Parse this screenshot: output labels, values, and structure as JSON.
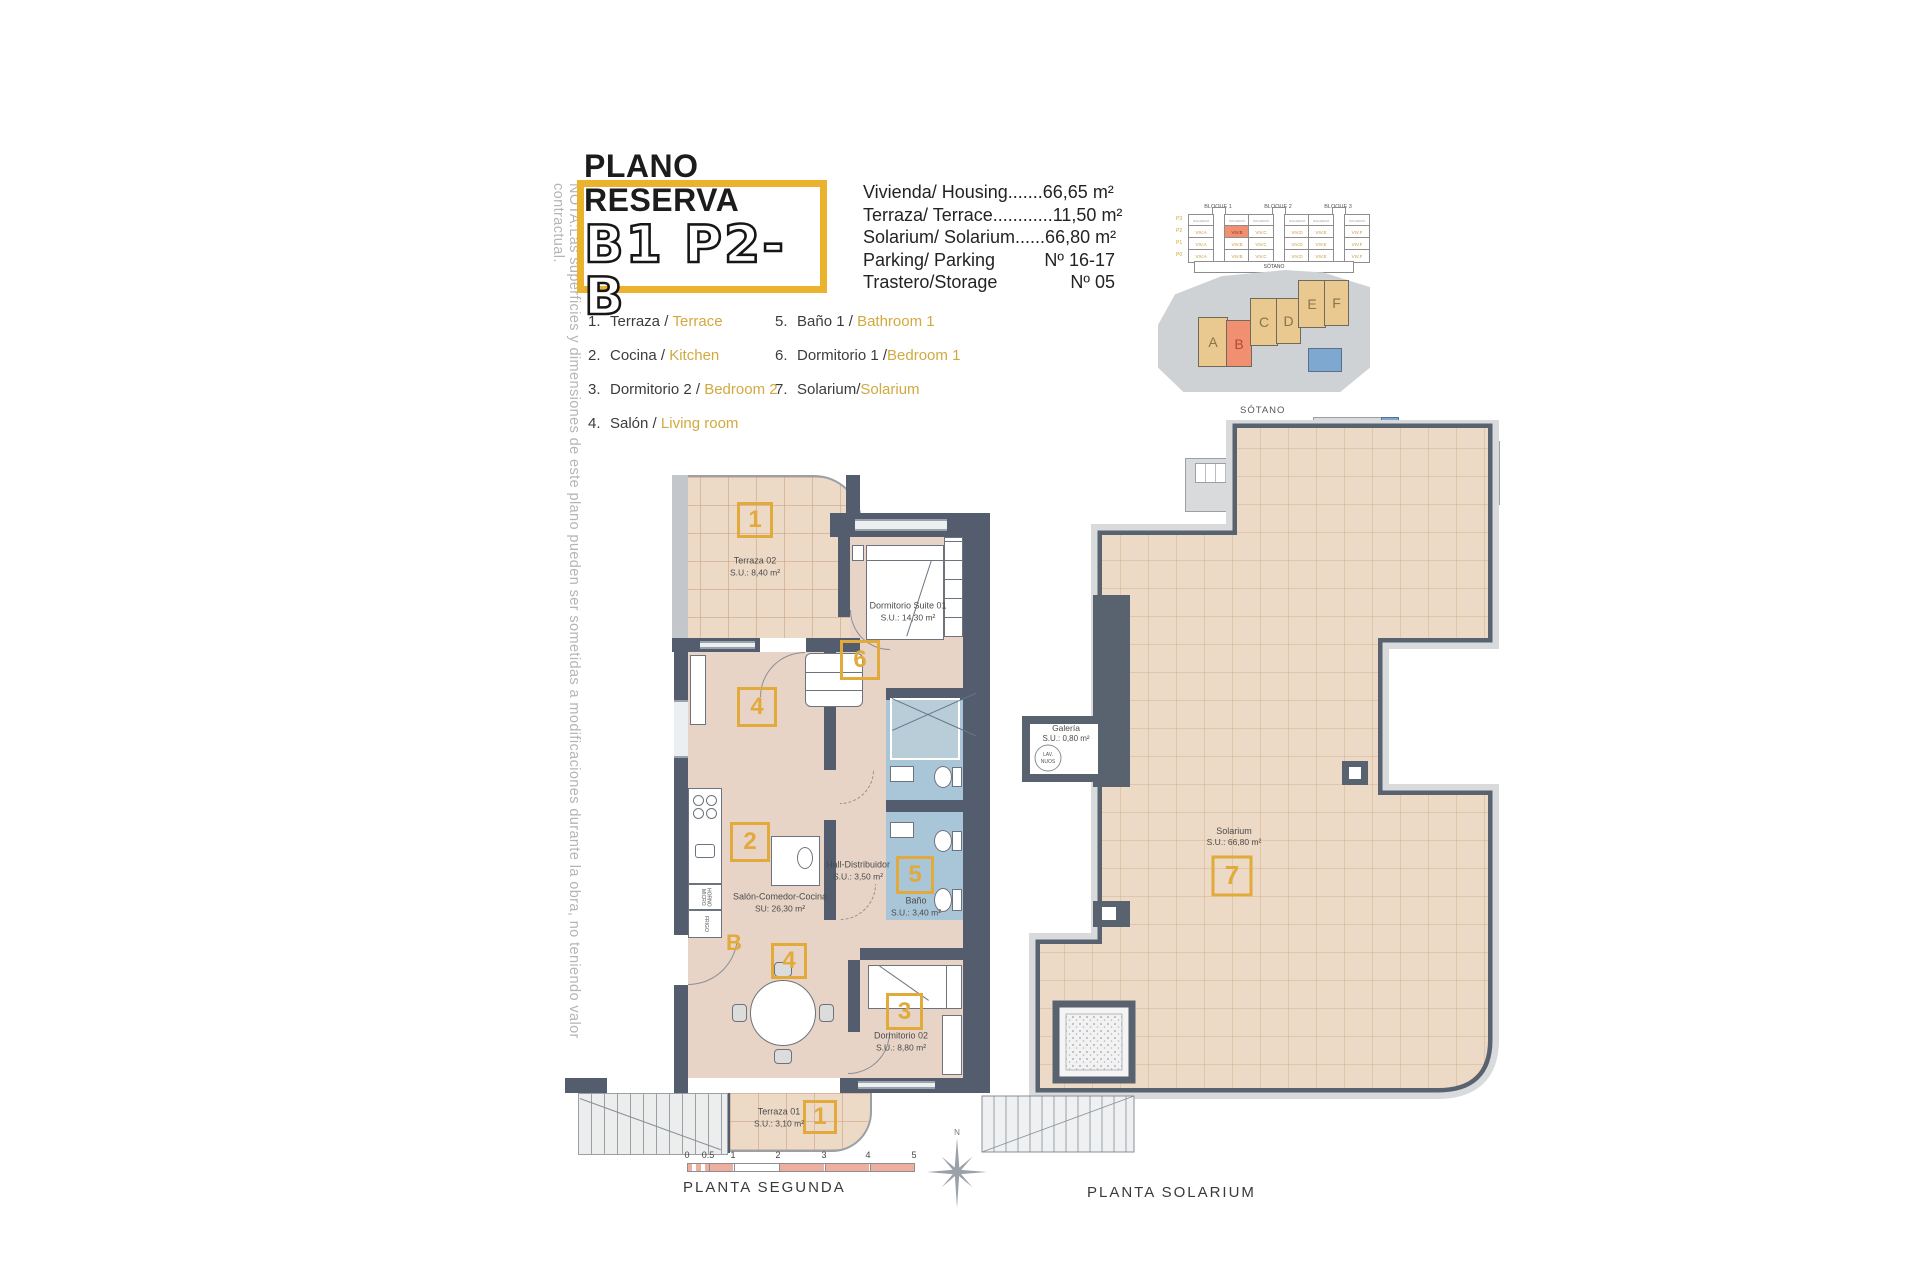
{
  "note": "NOTA:Las superficies y dimensiones de este plano pueden ser sometidas a modificaciones durante la obra, no teniendo valor contractual.",
  "title": {
    "line1": "PLANO RESERVA",
    "line2": "B1 P2-B"
  },
  "specs": {
    "rows": [
      {
        "text": "Vivienda/ Housing.......66,65 m²"
      },
      {
        "text": "Terraza/ Terrace............11,50 m²"
      },
      {
        "text": "Solarium/ Solarium......66,80 m²"
      }
    ],
    "parking_label": "Parking/ Parking",
    "parking_value": "Nº 16-17",
    "storage_label": "Trastero/Storage",
    "storage_value": "Nº 05"
  },
  "legend": {
    "col1": [
      {
        "num": "1.",
        "es": "Terraza",
        "sep": " / ",
        "en": "Terrace"
      },
      {
        "num": "2.",
        "es": "Cocina",
        "sep": " / ",
        "en": "Kitchen"
      },
      {
        "num": "3.",
        "es": "Dormitorio 2",
        "sep": " / ",
        "en": "Bedroom 2"
      },
      {
        "num": "4.",
        "es": "Salón",
        "sep": " / ",
        "en": "Living room"
      }
    ],
    "col2": [
      {
        "num": "5.",
        "es": "Baño 1",
        "sep": " / ",
        "en": "Bathroom 1"
      },
      {
        "num": "6.",
        "es": "Dormitorio 1",
        "sep": " /",
        "en": "Bedroom 1"
      },
      {
        "num": "7.",
        "es": "Solarium",
        "sep": "/",
        "en": "Solarium"
      }
    ]
  },
  "elevation": {
    "blocks": [
      "BLOQUE 1",
      "BLOQUE 2",
      "BLOQUE 3"
    ],
    "floors": [
      "P3",
      "P2",
      "P1",
      "P0"
    ],
    "units": [
      "VIV.A",
      "VIV.B",
      "VIV.C",
      "VIV.D",
      "VIV.E",
      "VIV.F"
    ],
    "top_label": "SOLARIUM",
    "basement": "SÓTANO",
    "highlighted_floor": "P2",
    "highlighted_unit": "VIV.B"
  },
  "site_plan": {
    "units": [
      "A",
      "B",
      "C",
      "D",
      "E",
      "F"
    ],
    "highlighted": "B"
  },
  "sotano_plan": {
    "label": "SÓTANO"
  },
  "plan_segunda": {
    "markers": {
      "terraza2": "1",
      "suite": "6",
      "salon_top": "4",
      "cocina": "2",
      "bano": "5",
      "salon_bottom": "4",
      "dorm2": "3",
      "terraza1": "1",
      "entrance_letter": "B"
    },
    "rooms": {
      "terraza2": {
        "name": "Terraza 02",
        "area": "S.U.: 8,40 m²"
      },
      "suite": {
        "name": "Dormitorio Suite 01",
        "area": "S.U.: 14,30 m²"
      },
      "hall": {
        "name": "Hall-Distribuidor",
        "area": "S.U.: 3,50 m²"
      },
      "salon": {
        "name": "Salón-Comedor-Cocina",
        "area": "SU: 26,30 m²"
      },
      "bano": {
        "name": "Baño",
        "area": "S.U.: 3,40 m²"
      },
      "dorm2": {
        "name": "Dormitorio 02",
        "area": "S.U.: 8,80 m²"
      },
      "terraza1": {
        "name": "Terraza 01",
        "area": "S.U.: 3,10 m²"
      }
    },
    "appliances": {
      "top": "HORNO MICRO",
      "bottom": "FRIGO"
    }
  },
  "plan_solarium": {
    "marker": "7",
    "rooms": {
      "solarium": {
        "name": "Solarium",
        "area": "S.U.: 66,80 m²"
      },
      "galeria": {
        "name": "Galería",
        "area": "S.U.: 0,80 m²"
      }
    },
    "laundry_line1": "LAV.",
    "laundry_line2": "NUOS"
  },
  "footer": {
    "planta_segunda": "PLANTA SEGUNDA",
    "planta_solarium": "PLANTA SOLARIUM",
    "scale_ticks": [
      "0",
      "0.5",
      "1",
      "2",
      "3",
      "4",
      "5"
    ],
    "north": "N"
  },
  "colors": {
    "accent_yellow": "#E2A93B",
    "title_border": "#EBB32D",
    "legend_yellow": "#D2A93F",
    "highlight_salmon": "#F09070",
    "wall_dark": "#535D6D",
    "floor_tan": "#E9D7C8",
    "bath_blue": "#A9C5D8",
    "site_tan": "#E9C98F",
    "scale_salmon": "#EFAF9F"
  }
}
